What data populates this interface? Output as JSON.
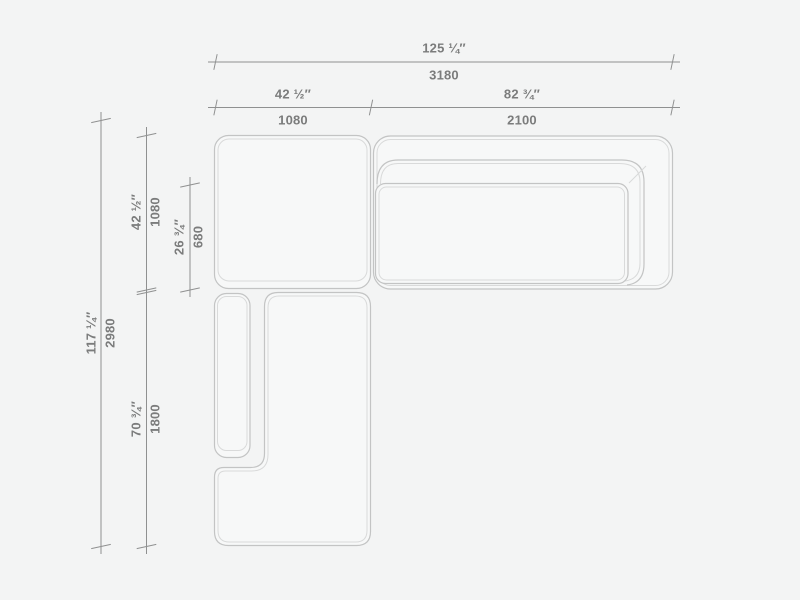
{
  "dimensions": {
    "overall_width": {
      "inches": "125 ¼″",
      "mm": "3180"
    },
    "left_module_width": {
      "inches": "42 ½″",
      "mm": "1080"
    },
    "right_module_width": {
      "inches": "82 ¾″",
      "mm": "2100"
    },
    "overall_depth": {
      "inches": "117 ¼″",
      "mm": "2980"
    },
    "top_module_depth": {
      "inches": "42 ½″",
      "mm": "1080"
    },
    "seat_depth": {
      "inches": "26 ¾″",
      "mm": "680"
    },
    "chaise_length": {
      "inches": "70 ¾″",
      "mm": "1800"
    }
  },
  "colors": {
    "background": "#f3f4f4",
    "module_fill": "#f7f8f8",
    "outline": "#c3c4c4",
    "outline_light": "#d9dada",
    "dimension_line": "#8f9090",
    "dimension_text": "#7b7c7c"
  }
}
